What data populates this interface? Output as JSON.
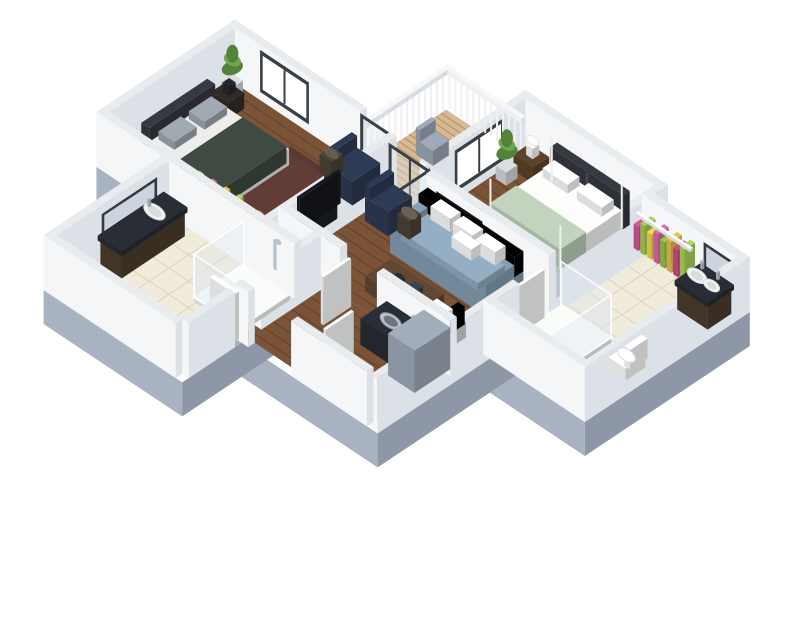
{
  "scene": {
    "title": "3d-apartment-floorplan-render",
    "background": "#ffffff",
    "view": "isometric-dollhouse"
  },
  "rooms": [
    {
      "name": "master-bedroom"
    },
    {
      "name": "ensuite-bathroom"
    },
    {
      "name": "living-room"
    },
    {
      "name": "balcony"
    },
    {
      "name": "second-bedroom"
    },
    {
      "name": "second-bathroom"
    },
    {
      "name": "hallway"
    }
  ],
  "colors": {
    "background": "#ffffff",
    "wall_top": "#e9ecef",
    "wall_light": "#f4f6f8",
    "wall_dark": "#dce1e7",
    "plinth_light": "#a9b2c1",
    "plinth_dark": "#8d97a7",
    "wood": "#7b5336",
    "wood_line": "rgba(40,22,10,0.30)",
    "tile": "#f1ebdb",
    "tile_line": "#ddd3bb",
    "deck": "#d8b992",
    "deck_line": "#b4946f",
    "rug": "#5a3833",
    "sofa": "#7e98ac",
    "sofa_cushion": "#8da6ba",
    "pillow": "#f3f4f3",
    "coffee_table": "#5d4430",
    "accent_chair": "#cdd0d4",
    "lamp": "#23262c",
    "navy": "#2c3850",
    "side_table": "#4a4034",
    "bed_white": "#f1f1ef",
    "sheet_grey": "#e2e3e1",
    "sage": "#b9cab5",
    "headboard": "#33363d",
    "bench": "#e8ebec",
    "nightstand": "#5a4027",
    "nightstand_dark": "#2e2a26",
    "grey_pillow": "#99a1aa",
    "blanket": "#3c463f",
    "tv": "#14171c",
    "marble": "#262b33",
    "vanity": "#4a3a2c",
    "fixture": "#f7f8f8",
    "shower_base": "#eef0ee",
    "glass": "#dfe9f0",
    "glass_frame": "#3a3f46",
    "mirror": "#ccd5dd",
    "mirror_frame": "#343942",
    "appliance": "#9aa5b3",
    "door": "#f6f7f8",
    "railing": "#eef0f3",
    "plant": "#54823a",
    "plant2": "#6da84e",
    "pot": "#cfd3d6",
    "silver": "#b9c2cb",
    "window_glass": "#ffffff"
  },
  "clothes_palette": [
    "#cf5090",
    "#9cc84e",
    "#e6d04e",
    "#d4689e",
    "#8fbf47",
    "#e0b84a",
    "#c2497f",
    "#a5cf55",
    "#dba94e",
    "#c95589",
    "#96c54b",
    "#e3c94f"
  ]
}
